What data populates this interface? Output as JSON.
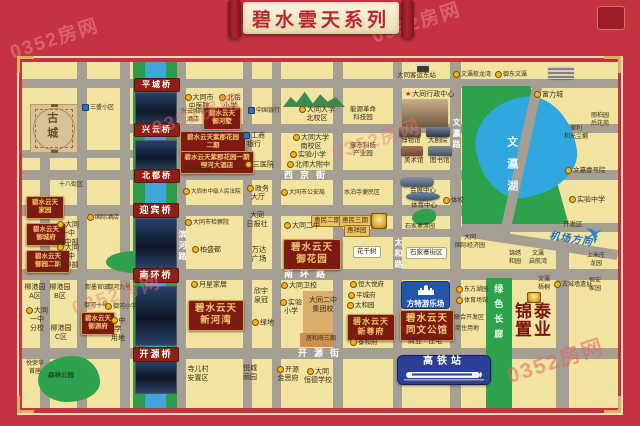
{
  "banner": {
    "title": "碧水雲天系列"
  },
  "watermark": "0352房网",
  "colors": {
    "frame_red": "#c53240",
    "project_maroon": "#7d1b12",
    "gold_text": "#f3c76d",
    "lake_blue": "#31a7e0",
    "park_green": "#2da24c",
    "road_gray": "#a59e92",
    "map_yellow": "#f1e3a0",
    "bridge_red": "#8c2016",
    "fantawild_blue": "#2356a8",
    "station_blue": "#2b3f96"
  },
  "special": {
    "fantawild": "方特游乐场",
    "station": "高铁站",
    "plane_icon": "✈"
  },
  "map": {
    "labels": [
      {
        "t": "西京街",
        "x": 284,
        "y": 170,
        "c": "street"
      },
      {
        "t": "南环路",
        "x": 284,
        "y": 269,
        "c": "street"
      },
      {
        "t": "开源街",
        "x": 298,
        "y": 348,
        "c": "street"
      },
      {
        "t": "文瀛路",
        "x": 451,
        "y": 118,
        "c": "street-v"
      },
      {
        "t": "太和路",
        "x": 393,
        "y": 238,
        "c": "street-v"
      },
      {
        "t": "滨河路",
        "x": 177,
        "y": 230,
        "c": "street-v"
      },
      {
        "t": "平城桥",
        "x": 134,
        "y": 78,
        "c": "bridge"
      },
      {
        "t": "兴云桥",
        "x": 134,
        "y": 123,
        "c": "bridge"
      },
      {
        "t": "北都桥",
        "x": 134,
        "y": 169,
        "c": "bridge"
      },
      {
        "t": "迎宾桥",
        "x": 133,
        "y": 203,
        "c": "bridge",
        "s": 9
      },
      {
        "t": "南环桥",
        "x": 133,
        "y": 268,
        "c": "bridge",
        "s": 9
      },
      {
        "t": "开源桥",
        "x": 133,
        "y": 347,
        "c": "bridge",
        "s": 9
      },
      {
        "t": "古城",
        "x": 44,
        "y": 112,
        "c": "oldtown-label"
      },
      {
        "t": "碧水云天\n御河墅",
        "x": 203,
        "y": 107,
        "w": 32,
        "s": 6.5,
        "c": "proj"
      },
      {
        "t": "碧水云天紫郡花园\n二期",
        "x": 180,
        "y": 131,
        "w": 60,
        "s": 6.5,
        "c": "proj"
      },
      {
        "t": "碧水云天紫郡花园一期\n御河大酒店",
        "x": 180,
        "y": 151,
        "w": 68,
        "s": 6.5,
        "c": "proj"
      },
      {
        "t": "碧水云天\n家园",
        "x": 26,
        "y": 196,
        "w": 32,
        "s": 6.5,
        "c": "proj"
      },
      {
        "t": "碧水云天\n御城府",
        "x": 26,
        "y": 223,
        "w": 34,
        "s": 6.5,
        "c": "proj"
      },
      {
        "t": "碧水云天\n御园二期",
        "x": 26,
        "y": 250,
        "w": 38,
        "s": 6.5,
        "c": "proj"
      },
      {
        "t": "碧水云天\n御源府",
        "x": 81,
        "y": 312,
        "w": 28,
        "s": 6.5,
        "c": "proj"
      },
      {
        "t": "碧水云天\n御花园",
        "x": 283,
        "y": 239,
        "w": 52,
        "c": "proj proj-lg",
        "n": "project-yuhuayuan"
      },
      {
        "t": "碧水云天\n新河湾",
        "x": 188,
        "y": 300,
        "w": 50,
        "c": "proj proj-lg",
        "n": "project-xinhewan"
      },
      {
        "t": "碧水云天\n新尊府",
        "x": 347,
        "y": 314,
        "w": 42,
        "s": 8,
        "c": "proj proj-lg",
        "n": "project-xinzunfu"
      },
      {
        "t": "碧水云天\n同文公馆",
        "x": 400,
        "y": 310,
        "w": 48,
        "c": "proj proj-lg",
        "n": "project-tongwen"
      },
      {
        "t": "商业 · 住宅",
        "x": 402,
        "y": 338,
        "w": 46,
        "s": 7
      },
      {
        "t": "惠民二期",
        "x": 311,
        "y": 215,
        "c": "zone"
      },
      {
        "t": "惠民三期",
        "x": 339,
        "y": 215,
        "c": "zone"
      },
      {
        "t": "惠祥园",
        "x": 344,
        "y": 225,
        "c": "zone"
      },
      {
        "t": "花千树",
        "x": 353,
        "y": 246,
        "c": "pill"
      },
      {
        "t": "石家寨街区",
        "x": 406,
        "y": 247,
        "c": "pill"
      },
      {
        "t": "锦泰\n置业",
        "x": 515,
        "y": 303,
        "c": "big-brand",
        "n": "jintai-brand"
      },
      {
        "t": "绿色长廊",
        "x": 492,
        "y": 284,
        "c": "corridor",
        "n": "green-corridor-label"
      },
      {
        "t": "文瀛湖",
        "x": 504,
        "y": 136,
        "c": "lake-label",
        "n": "lake-label"
      },
      {
        "t": "机场方向",
        "x": 549,
        "y": 234,
        "c": "airport",
        "n": "airport-direction-label"
      },
      {
        "t": "大同客运东站",
        "x": 397,
        "y": 72,
        "s": 6.5
      },
      {
        "t": "文瀛梳龙湾",
        "x": 453,
        "y": 71,
        "s": 6,
        "m": 1
      },
      {
        "t": "御东文瀛",
        "x": 495,
        "y": 71,
        "s": 6,
        "m": 1
      },
      {
        "t": "富力城",
        "x": 534,
        "y": 91,
        "m": 1
      },
      {
        "t": "丽柏园\n后花苑",
        "x": 586,
        "y": 113,
        "w": 28,
        "s": 6
      },
      {
        "t": "保利\n和光尘樾",
        "x": 560,
        "y": 126,
        "w": 32,
        "s": 6
      },
      {
        "t": "文瀛壹号院",
        "x": 565,
        "y": 167,
        "s": 6.5,
        "m": 1
      },
      {
        "t": "三盛小区",
        "x": 82,
        "y": 104,
        "s": 6,
        "m": 2
      },
      {
        "t": "大同市\n中医院",
        "x": 184,
        "y": 94,
        "w": 30,
        "m": 1
      },
      {
        "t": "北岳\n小学",
        "x": 219,
        "y": 94,
        "w": 22,
        "m": 1
      },
      {
        "t": "兴云国际\n酒店",
        "x": 180,
        "y": 109,
        "w": 26,
        "s": 6
      },
      {
        "t": "大同大学\n北校区",
        "x": 298,
        "y": 106,
        "w": 38,
        "m": 1
      },
      {
        "t": "大同大学\n南校区",
        "x": 292,
        "y": 134,
        "w": 38,
        "m": 1
      },
      {
        "t": "实验小学",
        "x": 290,
        "y": 151,
        "m": 1
      },
      {
        "t": "北师大附中",
        "x": 287,
        "y": 161,
        "m": 1
      },
      {
        "t": "中国银行",
        "x": 248,
        "y": 107,
        "s": 6,
        "m": 2
      },
      {
        "t": "工商\n银行",
        "x": 243,
        "y": 132,
        "w": 22,
        "m": 2
      },
      {
        "t": "三医院",
        "x": 245,
        "y": 161,
        "m": 1
      },
      {
        "t": "能源革命\n科技园",
        "x": 346,
        "y": 106,
        "w": 34,
        "s": 6.5
      },
      {
        "t": "御东科技\n产业园",
        "x": 346,
        "y": 142,
        "w": 34,
        "s": 6.5
      },
      {
        "t": "大同行政中心",
        "x": 405,
        "y": 91,
        "s": 7,
        "m": "s"
      },
      {
        "t": "博物馆",
        "x": 401,
        "y": 137,
        "s": 6.5
      },
      {
        "t": "大剧院",
        "x": 428,
        "y": 137,
        "s": 6.5
      },
      {
        "t": "美术馆",
        "x": 404,
        "y": 157,
        "s": 6.5
      },
      {
        "t": "图书馆",
        "x": 430,
        "y": 157,
        "s": 6.5
      },
      {
        "t": "会展中心",
        "x": 410,
        "y": 187,
        "s": 6.5
      },
      {
        "t": "体育中心",
        "x": 411,
        "y": 202,
        "s": 6.5
      },
      {
        "t": "体校",
        "x": 443,
        "y": 197,
        "s": 6.5,
        "m": 1
      },
      {
        "t": "政务\n大厅",
        "x": 247,
        "y": 185,
        "w": 22,
        "m": 1
      },
      {
        "t": "大同市公安局",
        "x": 281,
        "y": 189,
        "s": 6,
        "m": 1
      },
      {
        "t": "水泊寺便民区",
        "x": 344,
        "y": 190,
        "s": 6
      },
      {
        "t": "大同市中级人民法院",
        "x": 183,
        "y": 188,
        "s": 5.5,
        "m": 1
      },
      {
        "t": "大同市检察院",
        "x": 185,
        "y": 219,
        "s": 6,
        "m": 1
      },
      {
        "t": "十八街区",
        "x": 59,
        "y": 182,
        "s": 6
      },
      {
        "t": "国际酒店",
        "x": 87,
        "y": 214,
        "s": 6,
        "m": 1
      },
      {
        "t": "大同一中\n初中部",
        "x": 54,
        "y": 221,
        "w": 28,
        "m": 1
      },
      {
        "t": "大同一中\n高中部",
        "x": 54,
        "y": 244,
        "w": 28,
        "m": 1
      },
      {
        "t": "柏盛都",
        "x": 192,
        "y": 246,
        "m": 1
      },
      {
        "t": "大同\n日报社",
        "x": 244,
        "y": 212,
        "w": 26
      },
      {
        "t": "万达\n广场",
        "x": 248,
        "y": 245,
        "w": 22,
        "s": 7.5
      },
      {
        "t": "大同二中",
        "x": 284,
        "y": 222,
        "m": 1
      },
      {
        "t": "华丽蔓园",
        "x": 187,
        "y": 167,
        "s": 6
      },
      {
        "t": "石家寨游园",
        "x": 405,
        "y": 224,
        "s": 6
      },
      {
        "t": "大同\n国际经济园",
        "x": 455,
        "y": 235,
        "w": 30,
        "s": 6
      },
      {
        "t": "实验中学",
        "x": 569,
        "y": 196,
        "m": 1
      },
      {
        "t": "开发区",
        "x": 563,
        "y": 221,
        "s": 6.5
      },
      {
        "t": "锦绣\n和园",
        "x": 505,
        "y": 251,
        "w": 20,
        "s": 6
      },
      {
        "t": "文瀛\n启航湾",
        "x": 526,
        "y": 251,
        "w": 24,
        "s": 6
      },
      {
        "t": "上米庄\n龙园",
        "x": 584,
        "y": 253,
        "w": 24,
        "s": 6
      },
      {
        "t": "文瀛\n梧桐",
        "x": 534,
        "y": 277,
        "w": 20,
        "s": 6
      },
      {
        "t": "古城墙遗址",
        "x": 554,
        "y": 281,
        "s": 6,
        "m": 1
      },
      {
        "t": "恒安\n家园",
        "x": 584,
        "y": 278,
        "w": 22,
        "s": 6
      },
      {
        "t": "月星家居",
        "x": 191,
        "y": 281,
        "m": 1
      },
      {
        "t": "欣宇\n泉冠",
        "x": 251,
        "y": 288,
        "w": 20
      },
      {
        "t": "绿地",
        "x": 252,
        "y": 319,
        "m": 1
      },
      {
        "t": "大同卫校",
        "x": 281,
        "y": 282,
        "m": 1
      },
      {
        "t": "实验\n小学",
        "x": 280,
        "y": 299,
        "w": 22,
        "m": 1
      },
      {
        "t": "大同二中\n集团校",
        "x": 306,
        "y": 297,
        "w": 34
      },
      {
        "t": "居和府三期",
        "x": 306,
        "y": 336,
        "s": 6
      },
      {
        "t": "恒大悦府",
        "x": 350,
        "y": 281,
        "s": 6.5,
        "m": 1
      },
      {
        "t": "平城府",
        "x": 348,
        "y": 292,
        "s": 6.5,
        "m": 1
      },
      {
        "t": "太和园",
        "x": 347,
        "y": 302,
        "s": 6.5,
        "m": 1
      },
      {
        "t": "泰和府",
        "x": 350,
        "y": 339,
        "s": 6.5,
        "m": 1
      },
      {
        "t": "东方湖园",
        "x": 456,
        "y": 286,
        "s": 6,
        "m": 1
      },
      {
        "t": "体育场馆",
        "x": 456,
        "y": 297,
        "s": 6,
        "m": 1
      },
      {
        "t": "联合开发区",
        "x": 454,
        "y": 315,
        "s": 6
      },
      {
        "t": "商住用地",
        "x": 455,
        "y": 326,
        "s": 6
      },
      {
        "t": "柳港园\nA区",
        "x": 24,
        "y": 284,
        "w": 22
      },
      {
        "t": "柳港园\nB区",
        "x": 49,
        "y": 284,
        "w": 22
      },
      {
        "t": "大同一中\n分校",
        "x": 24,
        "y": 307,
        "w": 26,
        "m": 1
      },
      {
        "t": "柳港园\nC区",
        "x": 50,
        "y": 325,
        "w": 22
      },
      {
        "t": "熙墨官邸",
        "x": 85,
        "y": 285,
        "s": 6
      },
      {
        "t": "御河九号",
        "x": 107,
        "y": 285,
        "s": 6
      },
      {
        "t": "御河十号",
        "x": 84,
        "y": 303,
        "s": 6
      },
      {
        "t": "御河小学",
        "x": 105,
        "y": 303,
        "s": 6,
        "m": 1
      },
      {
        "t": "中学\n用地",
        "x": 109,
        "y": 317,
        "w": 18,
        "m": 1
      },
      {
        "t": "悦荣华\n首座",
        "x": 24,
        "y": 361,
        "w": 22,
        "s": 6
      },
      {
        "t": "森林公园",
        "x": 48,
        "y": 372,
        "s": 6.5,
        "c": "lbl parklbl"
      },
      {
        "t": "寺儿村\n安置区",
        "x": 184,
        "y": 366,
        "w": 28
      },
      {
        "t": "悦城\n丽园",
        "x": 240,
        "y": 365,
        "w": 20
      },
      {
        "t": "开源\n金思府",
        "x": 276,
        "y": 366,
        "w": 24,
        "m": 1
      },
      {
        "t": "大同\n恒德学校",
        "x": 304,
        "y": 368,
        "w": 28,
        "m": 1
      }
    ]
  }
}
